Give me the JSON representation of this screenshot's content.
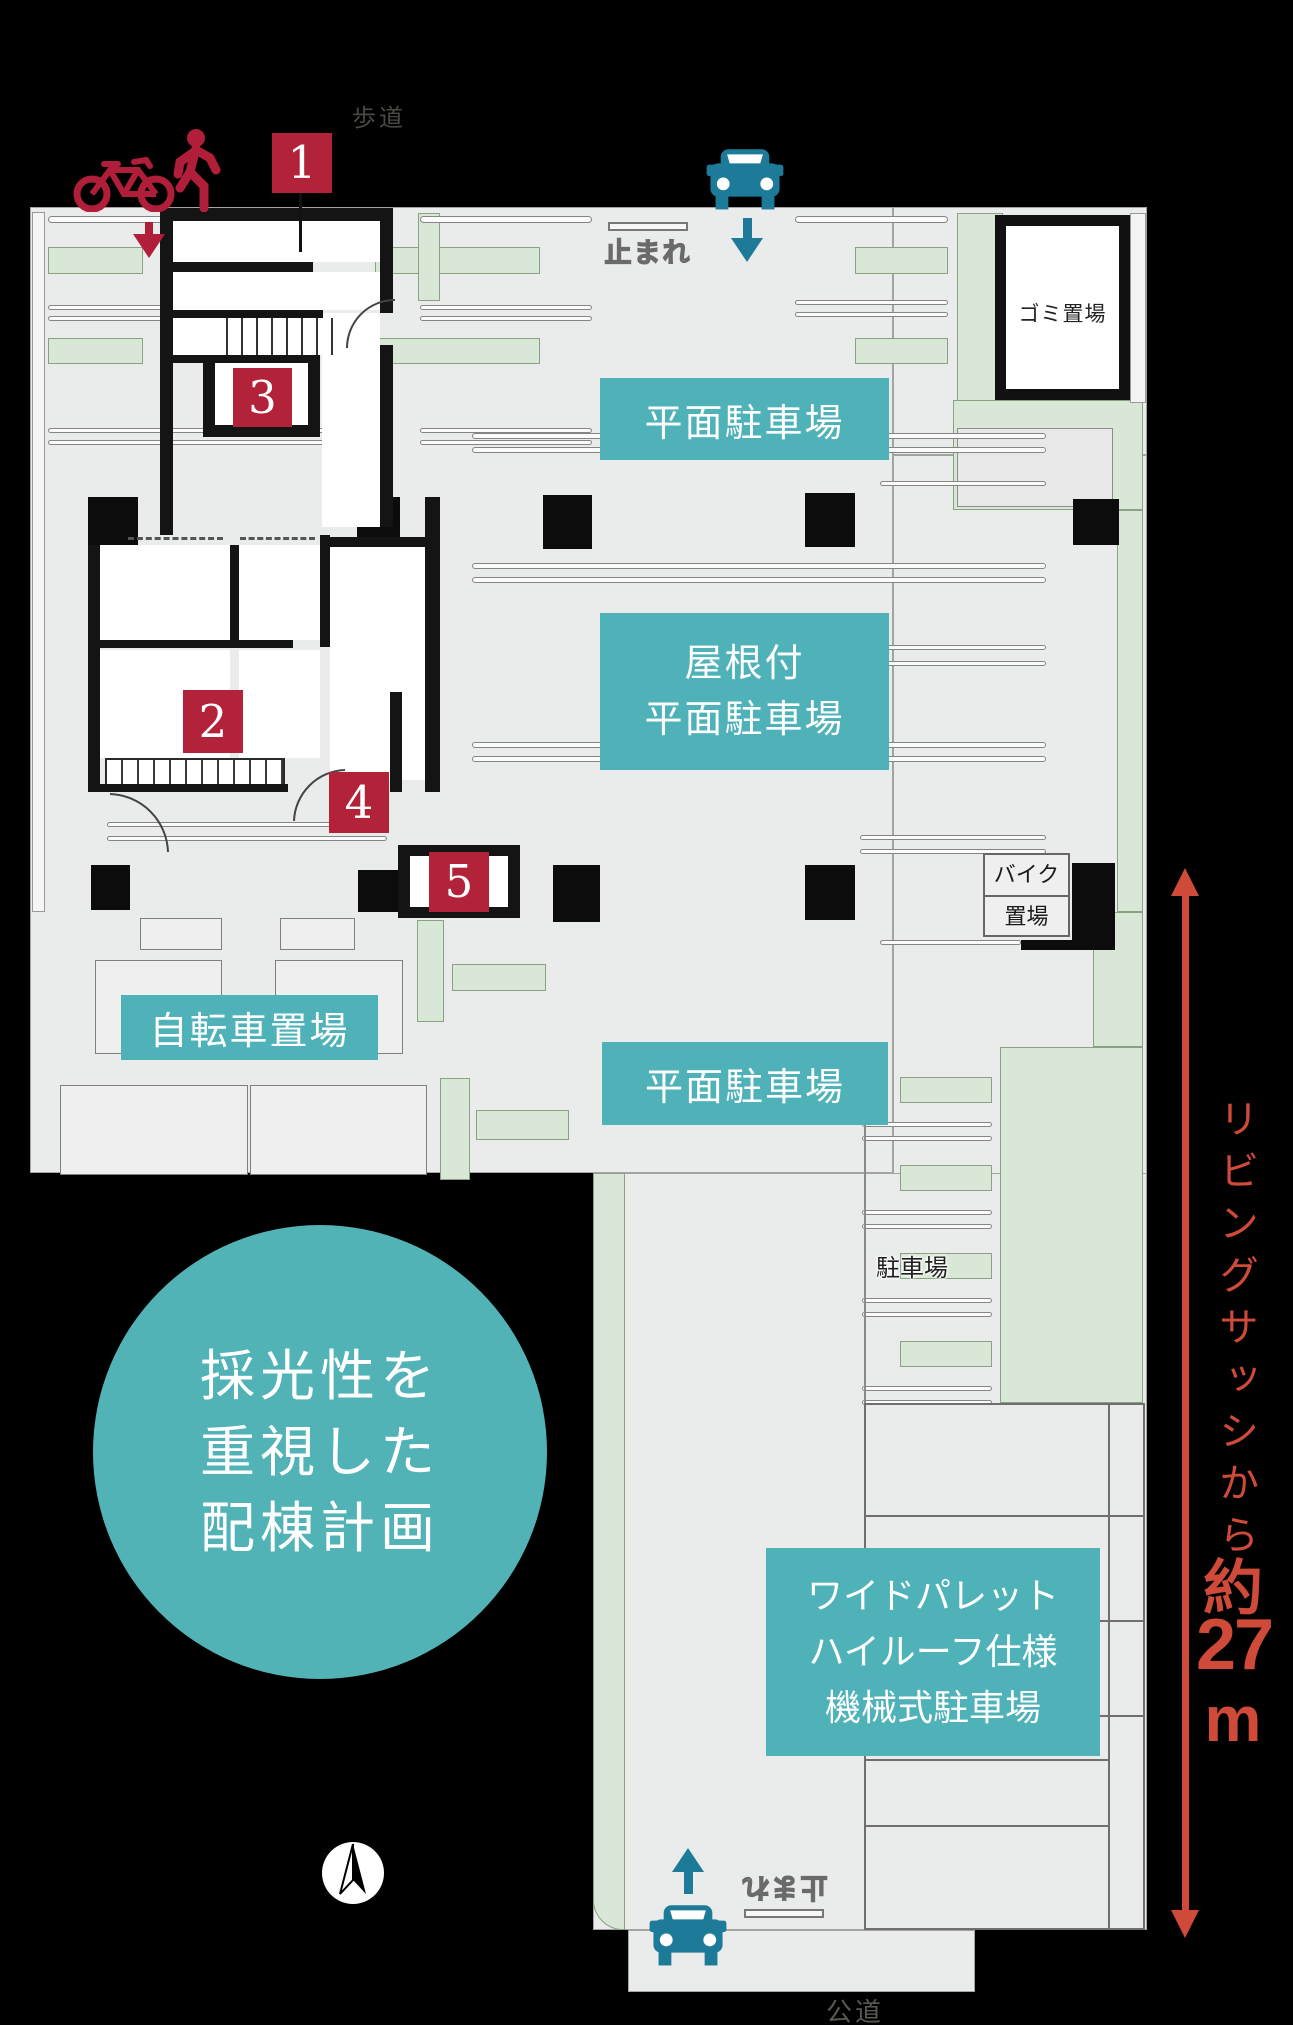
{
  "title": "配棟計画図",
  "colors": {
    "background": "#000000",
    "site_gray": "#eaebeb",
    "planting_green": "#d9e8d6",
    "label_teal": "#4fb2b8",
    "badge_red": "#b22239",
    "icon_crimson": "#b01e3a",
    "car_teal": "#1d7b99",
    "measure_red": "#cf4a38"
  },
  "labels": {
    "flat_parking_top": "平面駐車場",
    "roofed_line1": "屋根付",
    "roofed_line2": "平面駐車場",
    "bicycle_parking": "自転車置場",
    "flat_parking_mid": "平面駐車場",
    "mech_line1": "ワイドパレット",
    "mech_line2": "ハイルーフ仕様",
    "mech_line3": "機械式駐車場",
    "garbage": "ゴミ置場",
    "bike_line1": "バイク",
    "bike_line2": "置場",
    "parking_small": "駐車場"
  },
  "roads": {
    "sidewalk": "歩道",
    "public_road": "公道",
    "stop_marking": "止まれ"
  },
  "badges": [
    "1",
    "2",
    "3",
    "4",
    "5"
  ],
  "circle": {
    "line1": "採光性を",
    "line2": "重視した",
    "line3": "配棟計画"
  },
  "measure": {
    "label": "リビングサッシから",
    "approx": "約",
    "value": "27",
    "unit": "m"
  }
}
